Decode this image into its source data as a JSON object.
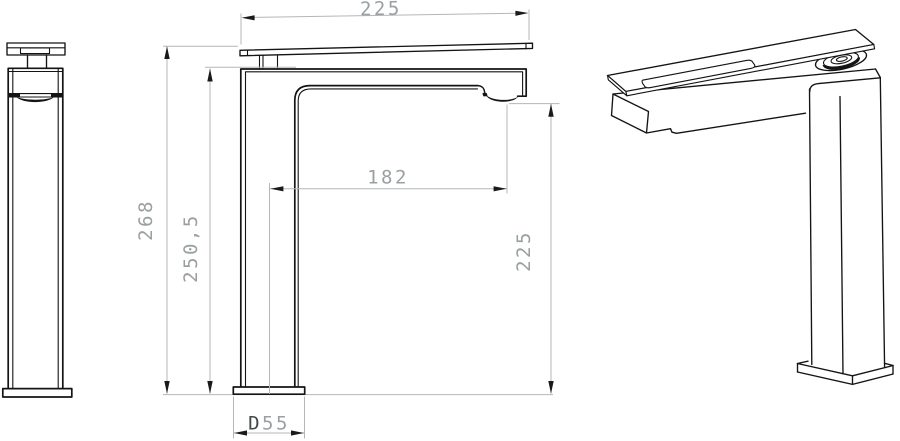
{
  "dimensions": {
    "top_width": {
      "value": "225"
    },
    "overall_height": {
      "value": "268"
    },
    "spout_top_height": {
      "value": "250,5"
    },
    "spout_reach": {
      "value": "182"
    },
    "outlet_height": {
      "value": "225"
    },
    "base_diameter": {
      "prefix": "D",
      "value": "55"
    }
  },
  "colors": {
    "background": "#ffffff",
    "outline": "#141414",
    "dimension_line": "#b3b7b9",
    "dimension_text": "#9aa0a2",
    "dimension_prefix": "#44494c"
  }
}
